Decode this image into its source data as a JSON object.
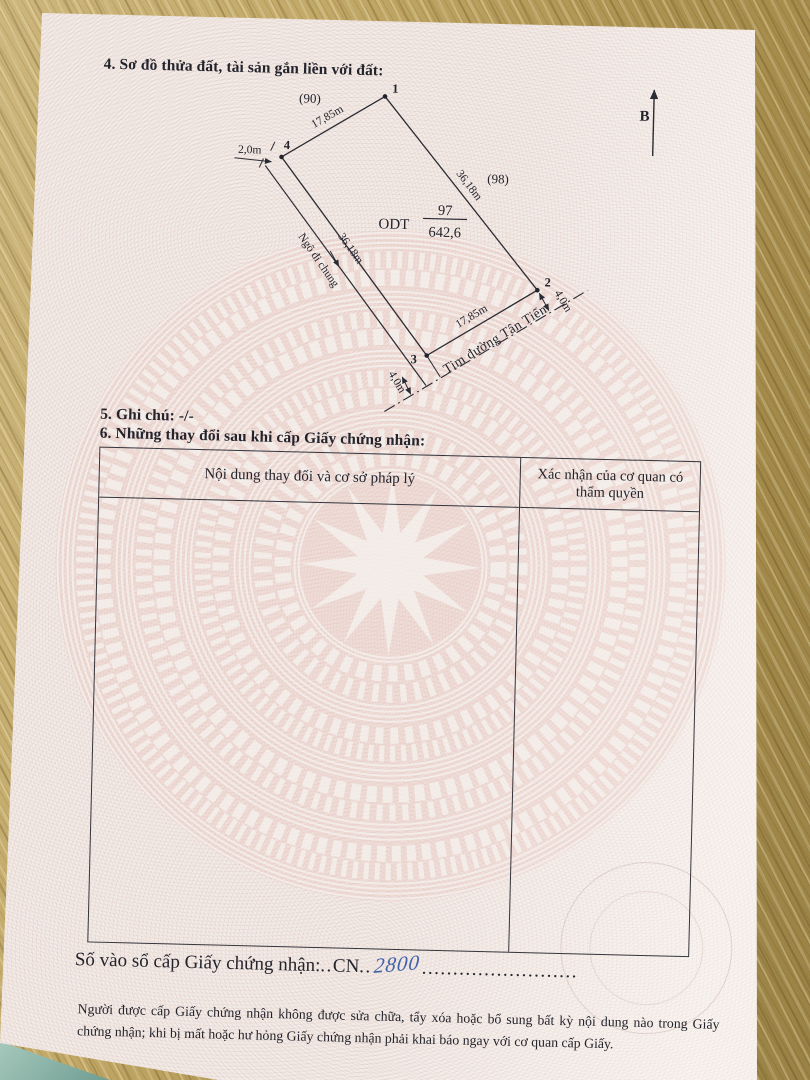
{
  "document": {
    "section4_heading": "4. Sơ đồ thửa đất, tài sản gắn liền với đất:",
    "section5_line": "5. Ghi chú: -/-",
    "section6_heading": "6. Những thay đổi sau khi cấp Giấy chứng nhận:",
    "registry": {
      "label": "Số vào sổ cấp Giấy chứng nhận:",
      "dots_before": "..",
      "code": "CN",
      "dots_mid": "..",
      "number": "2800",
      "dots_after": "........................."
    },
    "footer_note": "Người được cấp Giấy chứng nhận không được sửa chữa, tẩy xóa hoặc bổ sung bất kỳ nội dung nào trong Giấy chứng nhận; khi bị mất hoặc hư hỏng Giấy chứng nhận phải khai báo ngay với cơ quan cấp Giấy."
  },
  "table": {
    "headers": [
      "Nội dung thay đổi và cơ sở pháp lý",
      "Xác nhận của cơ quan có thẩm quyền"
    ]
  },
  "diagram": {
    "north_label": "B",
    "neighbor_top": "(90)",
    "neighbor_right": "(98)",
    "vertex_labels": [
      "1",
      "2",
      "3",
      "4"
    ],
    "len_top": "17,85m",
    "len_right": "36,18m",
    "len_bottom": "17,85m",
    "len_left": "36,18m",
    "land_code": "ODT",
    "plot_number": "97",
    "area_value": "642,6",
    "lane_width": "2,0m",
    "lane_name": "Ngõ đi chung",
    "road_name": "Tim đường Tân Tiến",
    "offset_near_2": "4,0m",
    "offset_near_3": "4,0m"
  },
  "colors": {
    "ink": "#23232c",
    "handwriting_blue": "#3f62a8",
    "drum_pink": "#e9c6c0",
    "paper": "#f2ece8",
    "wood_tan": "#b99f5e",
    "teal_object": "#7fa89d"
  }
}
